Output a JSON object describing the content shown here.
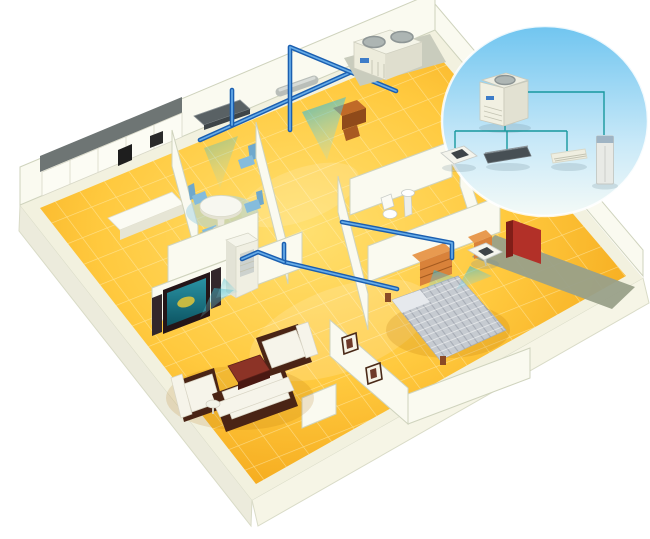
{
  "palette": {
    "background": "#ffffff",
    "floor_light": "#ffe070",
    "floor_mid": "#ffc93e",
    "floor_deep": "#ee9608",
    "grout": "#fff3c8",
    "slab": "#f2f1df",
    "slab_face_left": "#ecebdc",
    "slab_face_right": "#f6f5e6",
    "slab_edge": "#d9dbc7",
    "wall": "#fafaf0",
    "wall_edge": "#cfd3bd",
    "kitchen_band": "#6e7574",
    "olive_shadow": "#99a089",
    "pipe_dark": "#1b5fb0",
    "pipe_light": "#66ace8",
    "air": "#2fb3c8",
    "inset_sky": "#70c5f0",
    "inset_fade": "#f4faf7",
    "inset_line": "#17989e",
    "unit_cream": "#f0efe2",
    "unit_shade": "#dfdecf",
    "duct_dark": "#474f54",
    "screen_teal": "#2a93a4",
    "sofa_frame": "#4a2415",
    "upholstery": "#f6f4ea",
    "table_red": "#8c3326",
    "bed_silver": "#c6cbd1",
    "wood": "#d9823a",
    "wardrobe": "#b23028",
    "chair_blue": "#85bcdc",
    "tv_black": "#241518",
    "appliance_black": "#1e1e1e",
    "fan_gray": "#adb5b3"
  },
  "system_diagram": {
    "type": "hvac-multi-split-schematic",
    "outdoor_unit": {
      "name": "outdoor-condensing-unit"
    },
    "indoor_units": [
      {
        "name": "ceiling-cassette-unit"
      },
      {
        "name": "concealed-duct-unit"
      },
      {
        "name": "wall-mounted-unit"
      },
      {
        "name": "floor-standing-unit"
      }
    ],
    "links": "refrigerant-piping"
  },
  "house": {
    "style": "isometric-cutaway",
    "rooms": [
      {
        "name": "kitchen"
      },
      {
        "name": "dining-area"
      },
      {
        "name": "study"
      },
      {
        "name": "bathroom"
      },
      {
        "name": "bedroom"
      },
      {
        "name": "living-room"
      },
      {
        "name": "hallway"
      }
    ],
    "equipment": [
      {
        "name": "rooftop-outdoor-unit"
      },
      {
        "name": "ceiling-suspended-unit"
      },
      {
        "name": "duct-run"
      },
      {
        "name": "floor-standing-indoor-unit"
      },
      {
        "name": "bedroom-ceiling-cassette"
      },
      {
        "name": "refrigerant-piping"
      }
    ]
  }
}
